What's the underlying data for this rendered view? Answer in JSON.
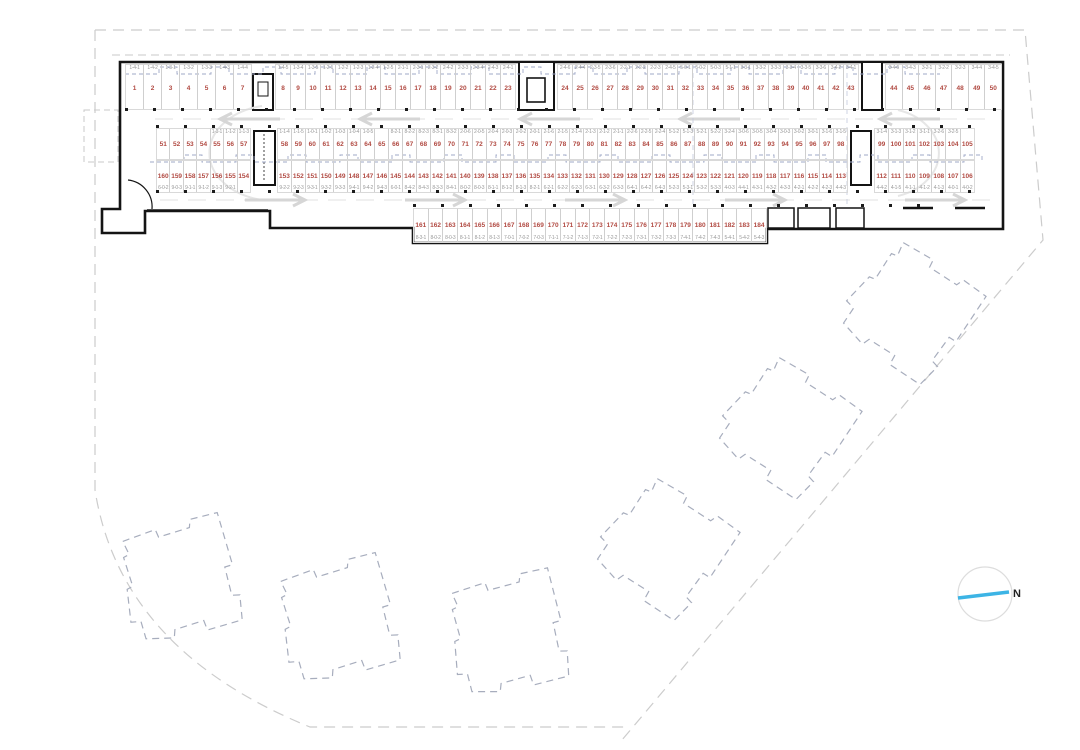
{
  "plan": {
    "north_label": "N",
    "colors": {
      "space_number": "#b14a42",
      "unit_code": "#9a9a9a",
      "wall": "#141414",
      "cell_divider": "#cfcfcf",
      "future_building_outline": "#a7adbd",
      "site_boundary": "#cccccc",
      "stepped_overlay_line": "#9fa8c7",
      "north_line": "#3cb4e5"
    },
    "parking": {
      "top_g1": [
        {
          "n": "1",
          "c": "1-4-1"
        },
        {
          "n": "2",
          "c": "1-4-2"
        },
        {
          "n": "3",
          "c": "1-3-1"
        },
        {
          "n": "4",
          "c": "1-3-2"
        },
        {
          "n": "5",
          "c": "1-3-3"
        },
        {
          "n": "6",
          "c": "1-4-3"
        },
        {
          "n": "7",
          "c": "1-4-4"
        }
      ],
      "top_g2": [
        {
          "n": "8",
          "c": "1-4-5"
        },
        {
          "n": "9",
          "c": "1-3-4"
        },
        {
          "n": "10",
          "c": "1-3-5"
        },
        {
          "n": "11",
          "c": "1-2-1"
        },
        {
          "n": "12",
          "c": "1-2-2"
        },
        {
          "n": "13",
          "c": "1-2-3"
        },
        {
          "n": "14",
          "c": "1-2-4"
        },
        {
          "n": "15",
          "c": "1-2-5"
        },
        {
          "n": "16",
          "c": "2-1-1"
        },
        {
          "n": "17",
          "c": "2-3-1"
        },
        {
          "n": "18",
          "c": "2-3-2"
        },
        {
          "n": "19",
          "c": "2-4-2"
        },
        {
          "n": "20",
          "c": "2-3-3"
        },
        {
          "n": "21",
          "c": "2-3-4"
        },
        {
          "n": "22",
          "c": "2-4-3"
        },
        {
          "n": "23",
          "c": "2-4-1"
        }
      ],
      "top_g3": [
        {
          "n": "24",
          "c": "2-4-6"
        },
        {
          "n": "25",
          "c": "2-4-4"
        },
        {
          "n": "26",
          "c": "2-3-5"
        },
        {
          "n": "27",
          "c": "2-3-6"
        },
        {
          "n": "28",
          "c": "2-2-1"
        },
        {
          "n": "29",
          "c": "2-2-2"
        },
        {
          "n": "30",
          "c": "2-2-3"
        },
        {
          "n": "31",
          "c": "2-4-5"
        },
        {
          "n": "32",
          "c": "5-0-1"
        },
        {
          "n": "33",
          "c": "5-0-2"
        },
        {
          "n": "34",
          "c": "5-0-3"
        },
        {
          "n": "35",
          "c": "5-1-1"
        },
        {
          "n": "36",
          "c": "3-3-1"
        },
        {
          "n": "37",
          "c": "3-3-2"
        },
        {
          "n": "38",
          "c": "3-3-3"
        },
        {
          "n": "39",
          "c": "3-3-4"
        },
        {
          "n": "40",
          "c": "3-3-5"
        },
        {
          "n": "41",
          "c": "3-3-6"
        },
        {
          "n": "42",
          "c": "3-4-2"
        },
        {
          "n": "43",
          "c": "3-4-1"
        }
      ],
      "top_g4": [
        {
          "n": "44",
          "c": "3-4-6"
        },
        {
          "n": "45",
          "c": "3-4-3"
        },
        {
          "n": "46",
          "c": "3-2-1"
        },
        {
          "n": "47",
          "c": "3-2-2"
        },
        {
          "n": "48",
          "c": "3-2-3"
        },
        {
          "n": "49",
          "c": "3-4-4"
        },
        {
          "n": "50",
          "c": "3-4-5"
        }
      ],
      "mu_g1": [
        {
          "n": "51",
          "c": ""
        },
        {
          "n": "52",
          "c": ""
        },
        {
          "n": "53",
          "c": ""
        },
        {
          "n": "54",
          "c": ""
        },
        {
          "n": "55",
          "c": "1-1-1"
        },
        {
          "n": "56",
          "c": "1-1-2"
        },
        {
          "n": "57",
          "c": "1-1-3"
        }
      ],
      "mu_g2": [
        {
          "n": "58",
          "c": "1-1-4"
        },
        {
          "n": "59",
          "c": "1-1-5"
        },
        {
          "n": "60",
          "c": "1-0-1"
        },
        {
          "n": "61",
          "c": "1-0-2"
        },
        {
          "n": "62",
          "c": "1-0-3"
        },
        {
          "n": "63",
          "c": "1-0-4"
        },
        {
          "n": "64",
          "c": "1-0-5"
        },
        {
          "n": "65",
          "c": ""
        },
        {
          "n": "66",
          "c": "8-2-1"
        },
        {
          "n": "67",
          "c": "8-2-2"
        },
        {
          "n": "68",
          "c": "8-2-3"
        },
        {
          "n": "69",
          "c": "8-3-1"
        },
        {
          "n": "70",
          "c": "8-3-2"
        },
        {
          "n": "71",
          "c": "2-0-6"
        },
        {
          "n": "72",
          "c": "2-0-5"
        },
        {
          "n": "73",
          "c": "2-0-4"
        },
        {
          "n": "74",
          "c": "2-0-3"
        },
        {
          "n": "75",
          "c": "2-0-2"
        },
        {
          "n": "76",
          "c": "2-0-1"
        },
        {
          "n": "77",
          "c": "2-1-6"
        },
        {
          "n": "78",
          "c": "2-1-5"
        },
        {
          "n": "79",
          "c": "2-1-4"
        },
        {
          "n": "80",
          "c": "2-1-3"
        },
        {
          "n": "81",
          "c": "2-1-2"
        },
        {
          "n": "82",
          "c": "2-1-1"
        },
        {
          "n": "83",
          "c": "2-2-6"
        },
        {
          "n": "84",
          "c": "2-2-5"
        },
        {
          "n": "85",
          "c": "2-2-4"
        },
        {
          "n": "86",
          "c": "5-1-2"
        },
        {
          "n": "87",
          "c": "5-1-3"
        },
        {
          "n": "88",
          "c": "5-2-1"
        },
        {
          "n": "89",
          "c": "5-2-2"
        },
        {
          "n": "90",
          "c": "3-2-4"
        },
        {
          "n": "91",
          "c": "3-0-6"
        },
        {
          "n": "92",
          "c": "3-0-5"
        },
        {
          "n": "93",
          "c": "3-0-4"
        },
        {
          "n": "94",
          "c": "3-0-3"
        },
        {
          "n": "95",
          "c": "3-0-2"
        },
        {
          "n": "96",
          "c": "3-0-1"
        },
        {
          "n": "97",
          "c": "3-1-6"
        },
        {
          "n": "98",
          "c": "3-1-5"
        }
      ],
      "mu_g3": [
        {
          "n": "99",
          "c": "3-1-4"
        },
        {
          "n": "100",
          "c": "3-1-3"
        },
        {
          "n": "101",
          "c": "3-1-2"
        },
        {
          "n": "102",
          "c": "3-1-1"
        },
        {
          "n": "103",
          "c": "3-2-6"
        },
        {
          "n": "104",
          "c": "3-2-5"
        },
        {
          "n": "105",
          "c": ""
        }
      ],
      "ml_g1": [
        {
          "n": "160",
          "c": "6-0-2"
        },
        {
          "n": "159",
          "c": "9-0-3"
        },
        {
          "n": "158",
          "c": "9-1-1"
        },
        {
          "n": "157",
          "c": "9-1-2"
        },
        {
          "n": "156",
          "c": "9-1-3"
        },
        {
          "n": "155",
          "c": "9-2-1"
        },
        {
          "n": "154",
          "c": ""
        }
      ],
      "ml_g2": [
        {
          "n": "153",
          "c": "9-2-2"
        },
        {
          "n": "152",
          "c": "9-2-3"
        },
        {
          "n": "151",
          "c": "9-3-1"
        },
        {
          "n": "150",
          "c": "9-3-2"
        },
        {
          "n": "149",
          "c": "9-3-3"
        },
        {
          "n": "148",
          "c": "9-4-1"
        },
        {
          "n": "147",
          "c": "9-4-2"
        },
        {
          "n": "146",
          "c": "9-4-3"
        },
        {
          "n": "145",
          "c": "6-0-1"
        },
        {
          "n": "144",
          "c": "8-4-2"
        },
        {
          "n": "143",
          "c": "8-4-3"
        },
        {
          "n": "142",
          "c": "8-3-3"
        },
        {
          "n": "141",
          "c": "8-4-1"
        },
        {
          "n": "140",
          "c": "8-0-2"
        },
        {
          "n": "139",
          "c": "8-0-3"
        },
        {
          "n": "138",
          "c": "8-1-1"
        },
        {
          "n": "137",
          "c": "8-1-2"
        },
        {
          "n": "136",
          "c": "8-1-3"
        },
        {
          "n": "135",
          "c": "8-2-1"
        },
        {
          "n": "134",
          "c": "6-2-1"
        },
        {
          "n": "133",
          "c": "6-2-2"
        },
        {
          "n": "132",
          "c": "6-2-3"
        },
        {
          "n": "131",
          "c": "6-3-1"
        },
        {
          "n": "130",
          "c": "6-3-2"
        },
        {
          "n": "129",
          "c": "6-3-3"
        },
        {
          "n": "128",
          "c": "6-4-1"
        },
        {
          "n": "127",
          "c": "6-4-2"
        },
        {
          "n": "126",
          "c": "6-4-3"
        },
        {
          "n": "125",
          "c": "5-2-3"
        },
        {
          "n": "124",
          "c": "5-3-1"
        },
        {
          "n": "123",
          "c": "5-3-2"
        },
        {
          "n": "122",
          "c": "5-3-3"
        },
        {
          "n": "121",
          "c": "4-0-3"
        },
        {
          "n": "120",
          "c": "4-4-1"
        },
        {
          "n": "119",
          "c": "4-3-1"
        },
        {
          "n": "118",
          "c": "4-3-2"
        },
        {
          "n": "117",
          "c": "4-3-3"
        },
        {
          "n": "116",
          "c": "4-2-1"
        },
        {
          "n": "115",
          "c": "4-2-2"
        },
        {
          "n": "114",
          "c": "4-2-3"
        },
        {
          "n": "113",
          "c": "4-4-3"
        }
      ],
      "ml_g3": [
        {
          "n": "112",
          "c": "4-4-2"
        },
        {
          "n": "111",
          "c": "4-1-5"
        },
        {
          "n": "110",
          "c": "4-1-1"
        },
        {
          "n": "109",
          "c": "4-1-2"
        },
        {
          "n": "108",
          "c": "4-1-3"
        },
        {
          "n": "107",
          "c": "4-0-1"
        },
        {
          "n": "106",
          "c": "4-0-2"
        }
      ],
      "bottom": [
        {
          "n": "161",
          "c": "8-3-1"
        },
        {
          "n": "162",
          "c": "8-0-2"
        },
        {
          "n": "163",
          "c": "8-0-3"
        },
        {
          "n": "164",
          "c": "8-1-1"
        },
        {
          "n": "165",
          "c": "8-1-2"
        },
        {
          "n": "166",
          "c": "8-1-3"
        },
        {
          "n": "167",
          "c": "7-0-1"
        },
        {
          "n": "168",
          "c": "7-0-2"
        },
        {
          "n": "169",
          "c": "7-0-3"
        },
        {
          "n": "170",
          "c": "7-1-1"
        },
        {
          "n": "171",
          "c": "7-1-2"
        },
        {
          "n": "172",
          "c": "7-1-3"
        },
        {
          "n": "173",
          "c": "7-2-1"
        },
        {
          "n": "174",
          "c": "7-2-2"
        },
        {
          "n": "175",
          "c": "7-2-3"
        },
        {
          "n": "176",
          "c": "7-3-1"
        },
        {
          "n": "177",
          "c": "7-3-2"
        },
        {
          "n": "178",
          "c": "7-3-3"
        },
        {
          "n": "179",
          "c": "7-4-1"
        },
        {
          "n": "180",
          "c": "7-4-2"
        },
        {
          "n": "181",
          "c": "7-4-3"
        },
        {
          "n": "182",
          "c": "5-4-1"
        },
        {
          "n": "183",
          "c": "5-4-2"
        },
        {
          "n": "184",
          "c": "5-4-3"
        }
      ]
    }
  }
}
